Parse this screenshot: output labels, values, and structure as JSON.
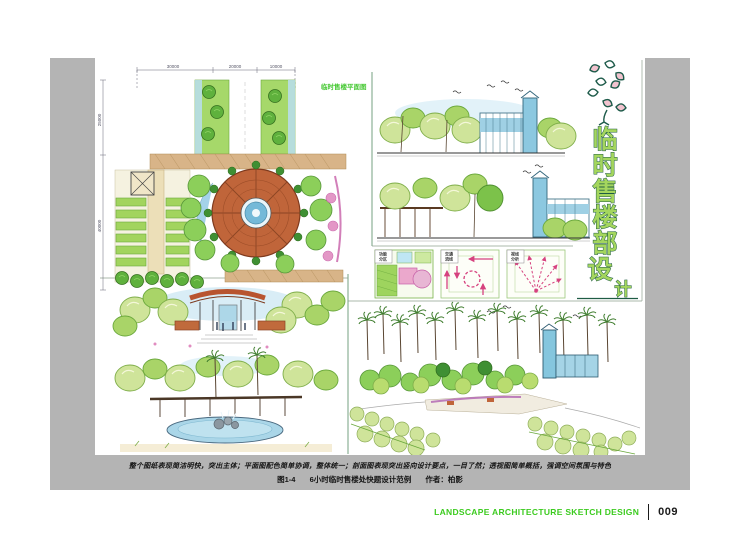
{
  "captions": {
    "line1": "整个图纸表现简洁明快，突出主体；平面图配色简单协调，整体统一；剖面图表现突出竖向设计要点，一目了然；透视图简单概括，强调空间氛围与特色",
    "figure_no": "图1-4",
    "figure_title": "6小时临时售楼处快题设计范例",
    "author": "作者：柏影"
  },
  "footer": {
    "series_title": "LANDSCAPE ARCHITECTURE SKETCH DESIGN",
    "page_number": "009"
  },
  "artwork": {
    "vertical_title": "临时售楼部设计",
    "title_chars": [
      "临",
      "时",
      "售",
      "楼",
      "部",
      "设",
      "计"
    ],
    "plan_label": "临时售楼平面图",
    "dims_top": [
      "30000",
      "20000",
      "10000"
    ],
    "dims_left": [
      "25000",
      "40000"
    ],
    "analysis_labels": [
      {
        "l1": "功能",
        "l2": "分区"
      },
      {
        "l1": "交通",
        "l2": "流线"
      },
      {
        "l1": "视线",
        "l2": "分析"
      }
    ]
  },
  "colors": {
    "mat-gray": "#b4b4b4",
    "footer-green": "#3ccb1f",
    "title-green": "#a4d65e",
    "title-outline": "#1f5c44",
    "terracotta": "#c0653a",
    "water-blue": "#8ec8e0",
    "foliage-green": "#8ccf5a",
    "analysis-pink": "#d6427f"
  }
}
